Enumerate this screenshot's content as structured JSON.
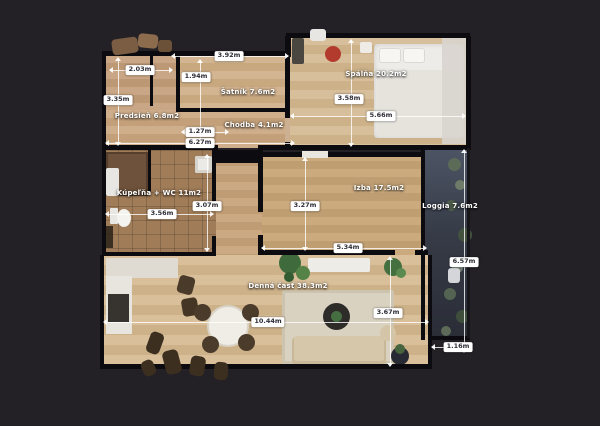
{
  "floorplan": {
    "background_color": "#232126",
    "wall_color": "#0c0b0f",
    "badge_bg_color": "#ffffff",
    "badge_text_color": "#2d2d36",
    "room_label_color": "#ffffff",
    "loggia_floor_color": "#3a3f4b",
    "wood_floor_color": "#ccab85",
    "rooms": [
      {
        "name": "predsien",
        "label": "Predsieň 6.8m2"
      },
      {
        "name": "satnik",
        "label": "Šatník 7.6m2"
      },
      {
        "name": "chodba",
        "label": "Chodba 4.1m2"
      },
      {
        "name": "spalna",
        "label": "Spálňa 20.2m2"
      },
      {
        "name": "kupelna",
        "label": "Kúpeľňa + WC 11m2"
      },
      {
        "name": "izba",
        "label": "Izba 17.5m2"
      },
      {
        "name": "loggia",
        "label": "Loggia 7.6m2"
      },
      {
        "name": "denna_cast",
        "label": "Denná časť 38.3m2"
      }
    ],
    "measurements": [
      {
        "name": "predsien-width",
        "label": "2.03m"
      },
      {
        "name": "predsien-height",
        "label": "3.35m"
      },
      {
        "name": "satnik-height",
        "label": "1.94m"
      },
      {
        "name": "satnik-width",
        "label": "3.92m"
      },
      {
        "name": "chodba-width",
        "label": "1.27m"
      },
      {
        "name": "top-section-width",
        "label": "6.27m"
      },
      {
        "name": "spalna-height",
        "label": "3.58m"
      },
      {
        "name": "spalna-width",
        "label": "5.66m"
      },
      {
        "name": "kupelna-height",
        "label": "3.07m"
      },
      {
        "name": "kupelna-width",
        "label": "3.56m"
      },
      {
        "name": "izba-height",
        "label": "3.27m"
      },
      {
        "name": "izba-width",
        "label": "5.34m"
      },
      {
        "name": "loggia-height",
        "label": "6.57m"
      },
      {
        "name": "loggia-width",
        "label": "1.16m"
      },
      {
        "name": "denna-width",
        "label": "10.44m"
      },
      {
        "name": "denna-height",
        "label": "3.67m"
      }
    ]
  }
}
